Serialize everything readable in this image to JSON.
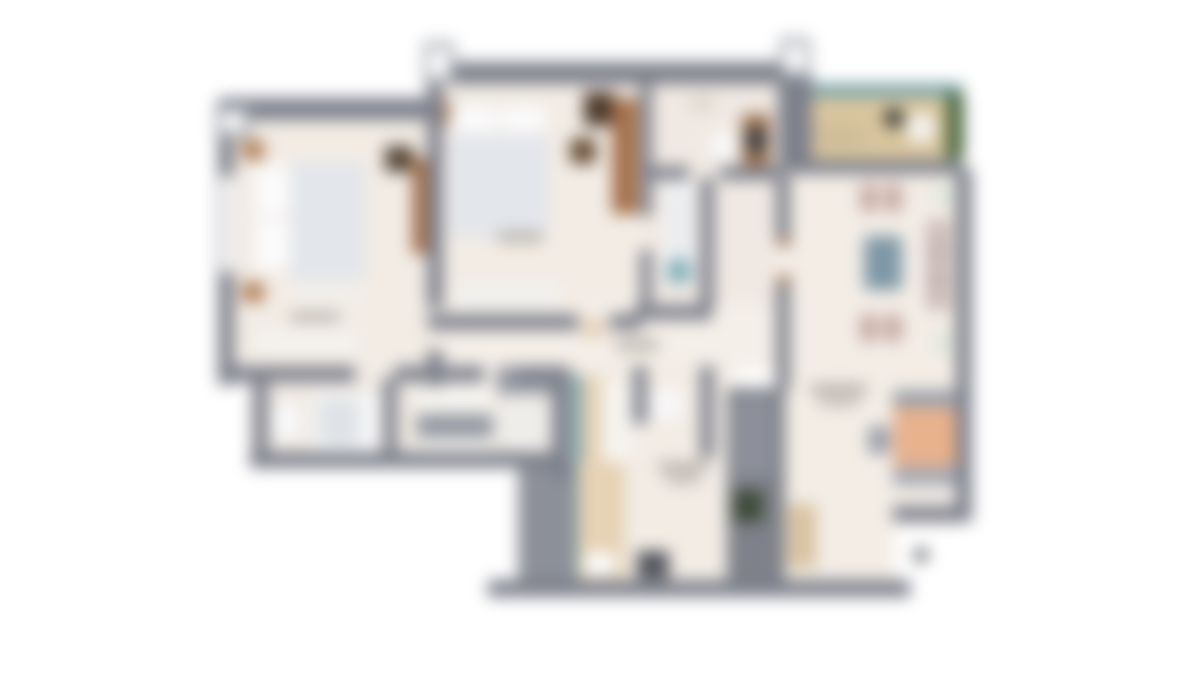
{
  "plan": {
    "background": "#ffffff",
    "blur_px": 8,
    "palette": {
      "wall": "#7d808b",
      "wall_light": "#9aa0a8",
      "floor": "#f2ece5",
      "floor_hall": "#f5efe9",
      "balcony_wood": "#d8c59e",
      "glass_teal": "#5b929b",
      "plant_green": "#4c683f",
      "bed_duvet": "#e3e6eb",
      "pillow_white": "#fbfbfc",
      "wood_brown": "#a5714b",
      "wood_dark": "#57483a",
      "chair_mauve": "#c6a8a2",
      "table_blue": "#7e98a6",
      "sofa_peach": "#e8b28c",
      "kitchen_tan": "#e6d2b4",
      "shaft_gray": "#7e8189",
      "label_smudge": "#b3ada7"
    },
    "shapes": [
      {
        "n": "bedroom1-floor",
        "x": 225,
        "y": 105,
        "w": 210,
        "h": 266,
        "c": "#f2ece5"
      },
      {
        "n": "bedroom2-floor",
        "x": 435,
        "y": 70,
        "w": 210,
        "h": 250,
        "c": "#f2ece5"
      },
      {
        "n": "bathroom-a-floor",
        "x": 645,
        "y": 70,
        "w": 140,
        "h": 104,
        "c": "#f0e9e3"
      },
      {
        "n": "bathroom-b-floor",
        "x": 645,
        "y": 175,
        "w": 135,
        "h": 140,
        "c": "#f0e9e3"
      },
      {
        "n": "balcony-floor",
        "x": 800,
        "y": 92,
        "w": 158,
        "h": 70,
        "c": "#d8c59e"
      },
      {
        "n": "living-floor",
        "x": 783,
        "y": 165,
        "w": 180,
        "h": 360,
        "c": "#f3ede6"
      },
      {
        "n": "living-floor-lower",
        "x": 783,
        "y": 520,
        "w": 112,
        "h": 66,
        "c": "#f3ede6"
      },
      {
        "n": "hall-floor",
        "x": 435,
        "y": 305,
        "w": 355,
        "h": 66,
        "c": "#f5efe9"
      },
      {
        "n": "bathroom-block-floor",
        "x": 248,
        "y": 372,
        "w": 310,
        "h": 88,
        "c": "#efe9e2"
      },
      {
        "n": "entry-floor",
        "x": 565,
        "y": 360,
        "w": 170,
        "h": 224,
        "c": "#f2ece5"
      },
      {
        "n": "bed1-pillow-top",
        "x": 255,
        "y": 166,
        "w": 34,
        "h": 50,
        "c": "#fbfbfc",
        "r": 6
      },
      {
        "n": "bed1-pillow-bottom",
        "x": 255,
        "y": 220,
        "w": 34,
        "h": 50,
        "c": "#fbfbfc",
        "r": 6
      },
      {
        "n": "bed1-duvet",
        "x": 291,
        "y": 162,
        "w": 74,
        "h": 118,
        "c": "#e3e6eb",
        "r": 3
      },
      {
        "n": "bed1-nightstand-top",
        "x": 242,
        "y": 140,
        "w": 22,
        "h": 20,
        "c": "#b08157"
      },
      {
        "n": "bed1-nightstand-bottom",
        "x": 242,
        "y": 282,
        "w": 22,
        "h": 20,
        "c": "#b08157"
      },
      {
        "n": "bed1-dresser",
        "x": 385,
        "y": 146,
        "w": 28,
        "h": 26,
        "c": "#57483a"
      },
      {
        "n": "bed1-bench",
        "x": 293,
        "y": 284,
        "w": 62,
        "h": 20,
        "c": "#f1efec"
      },
      {
        "n": "bed1-low-dresser",
        "x": 258,
        "y": 332,
        "w": 96,
        "h": 22,
        "c": "#f4f2ef"
      },
      {
        "n": "bed1-wardrobe",
        "x": 412,
        "y": 158,
        "w": 16,
        "h": 96,
        "c": "#a5714b"
      },
      {
        "n": "bedroom1-label-smudge",
        "x": 290,
        "y": 312,
        "w": 50,
        "h": 9,
        "c": "#b3ada7",
        "r": 4
      },
      {
        "n": "bed2-pillow-left",
        "x": 453,
        "y": 107,
        "w": 44,
        "h": 25,
        "c": "#fbfbfc",
        "r": 6
      },
      {
        "n": "bed2-pillow-right",
        "x": 501,
        "y": 107,
        "w": 44,
        "h": 25,
        "c": "#fbfbfc",
        "r": 6
      },
      {
        "n": "bed2-duvet",
        "x": 450,
        "y": 134,
        "w": 98,
        "h": 104,
        "c": "#e3e6eb",
        "r": 3
      },
      {
        "n": "bed2-nightstand-left",
        "x": 432,
        "y": 100,
        "w": 18,
        "h": 24,
        "c": "#b08157"
      },
      {
        "n": "bed2-side-chair",
        "x": 570,
        "y": 138,
        "w": 26,
        "h": 26,
        "c": "#6b5138",
        "r": 4
      },
      {
        "n": "bed2-dark-dresser",
        "x": 584,
        "y": 92,
        "w": 30,
        "h": 34,
        "c": "#4e3b2c"
      },
      {
        "n": "bed2-wardrobe",
        "x": 612,
        "y": 98,
        "w": 26,
        "h": 116,
        "c": "#a5714b"
      },
      {
        "n": "bed2-bench",
        "x": 458,
        "y": 284,
        "w": 100,
        "h": 24,
        "c": "#f2f1ee"
      },
      {
        "n": "bedroom2-label-smudge",
        "x": 497,
        "y": 232,
        "w": 46,
        "h": 10,
        "c": "#b3ada7",
        "r": 4
      },
      {
        "n": "bed2-door-swing",
        "x": 580,
        "y": 318,
        "w": 26,
        "h": 20,
        "c": "#e6d2ba",
        "r": 6
      },
      {
        "n": "bathroom-a-vanity",
        "x": 742,
        "y": 114,
        "w": 28,
        "h": 60,
        "c": "#9c7350"
      },
      {
        "n": "bathroom-a-sink",
        "x": 746,
        "y": 128,
        "w": 20,
        "h": 24,
        "c": "#3f4147",
        "r": 4
      },
      {
        "n": "bathroom-a-toilet",
        "x": 710,
        "y": 132,
        "w": 26,
        "h": 28,
        "c": "#f8f8f9",
        "r": 8
      },
      {
        "n": "bathroom-a-shelf",
        "x": 690,
        "y": 96,
        "w": 24,
        "h": 14,
        "c": "#ddd5ca"
      },
      {
        "n": "bathroom-b-tub",
        "x": 664,
        "y": 180,
        "w": 32,
        "h": 100,
        "c": "#f6f6f7",
        "r": 10
      },
      {
        "n": "bathroom-b-tub-inner",
        "x": 670,
        "y": 188,
        "w": 20,
        "h": 84,
        "c": "#e9ebee",
        "r": 8
      },
      {
        "n": "bathroom-b-toilet",
        "x": 666,
        "y": 258,
        "w": 26,
        "h": 26,
        "c": "#7fb0ba",
        "r": "50%"
      },
      {
        "n": "balcony-glass-rail",
        "x": 796,
        "y": 84,
        "w": 166,
        "h": 12,
        "c": "#6f9da3"
      },
      {
        "n": "balcony-plants",
        "x": 946,
        "y": 92,
        "w": 18,
        "h": 68,
        "c": "#4c683f",
        "r": 6
      },
      {
        "n": "balcony-plant-pot",
        "x": 884,
        "y": 108,
        "w": 20,
        "h": 20,
        "c": "#3b3d36",
        "r": "50%"
      },
      {
        "n": "balcony-chair",
        "x": 908,
        "y": 114,
        "w": 26,
        "h": 28,
        "c": "#f5f4f1",
        "r": 6
      },
      {
        "n": "balcony-table",
        "x": 818,
        "y": 128,
        "w": 44,
        "h": 18,
        "c": "#cdbb96",
        "r": 4
      },
      {
        "n": "dining-chair-1",
        "x": 860,
        "y": 184,
        "w": 18,
        "h": 28,
        "c": "#c6a8a2",
        "r": 5
      },
      {
        "n": "dining-chair-2",
        "x": 884,
        "y": 184,
        "w": 18,
        "h": 28,
        "c": "#c6a8a2",
        "r": 5
      },
      {
        "n": "dining-plant-top",
        "x": 932,
        "y": 184,
        "w": 22,
        "h": 22,
        "c": "#dfe8dc",
        "r": "50%"
      },
      {
        "n": "dining-table",
        "x": 864,
        "y": 236,
        "w": 38,
        "h": 54,
        "c": "#7e98a6",
        "r": 4
      },
      {
        "n": "dining-chair-3",
        "x": 860,
        "y": 314,
        "w": 18,
        "h": 28,
        "c": "#c6a8a2",
        "r": 5
      },
      {
        "n": "dining-chair-4",
        "x": 884,
        "y": 314,
        "w": 18,
        "h": 28,
        "c": "#c6a8a2",
        "r": 5
      },
      {
        "n": "dining-plant-bottom",
        "x": 932,
        "y": 332,
        "w": 22,
        "h": 22,
        "c": "#dfe8dc",
        "r": "50%"
      },
      {
        "n": "living-sideboard",
        "x": 926,
        "y": 220,
        "w": 24,
        "h": 90,
        "c": "#ccbbb7",
        "r": 3
      },
      {
        "n": "sideboard-divider-1",
        "x": 926,
        "y": 250,
        "w": 24,
        "h": 4,
        "c": "#a8a4a5"
      },
      {
        "n": "sideboard-divider-2",
        "x": 926,
        "y": 278,
        "w": 24,
        "h": 4,
        "c": "#a8a4a5"
      },
      {
        "n": "living-label-smudge-1",
        "x": 810,
        "y": 384,
        "w": 58,
        "h": 10,
        "c": "#b3ada7",
        "r": 4
      },
      {
        "n": "living-label-smudge-2",
        "x": 818,
        "y": 398,
        "w": 42,
        "h": 8,
        "c": "#b9b4ae",
        "r": 4
      },
      {
        "n": "sofa-back",
        "x": 893,
        "y": 390,
        "w": 64,
        "h": 17,
        "c": "#9aa0aa"
      },
      {
        "n": "sofa-body",
        "x": 893,
        "y": 407,
        "w": 64,
        "h": 59,
        "c": "#e8b28c"
      },
      {
        "n": "sofa-front",
        "x": 893,
        "y": 466,
        "w": 64,
        "h": 20,
        "c": "#a7abb4"
      },
      {
        "n": "sofa-ottoman",
        "x": 868,
        "y": 426,
        "w": 22,
        "h": 28,
        "c": "#9aa0aa",
        "r": 4
      },
      {
        "n": "tv-console",
        "x": 788,
        "y": 504,
        "w": 28,
        "h": 64,
        "c": "#d8c39f"
      },
      {
        "n": "hall-label-smudge",
        "x": 615,
        "y": 340,
        "w": 44,
        "h": 10,
        "c": "#b3ada7",
        "r": 4
      },
      {
        "n": "hall-wardrobe-top",
        "x": 417,
        "y": 384,
        "w": 76,
        "h": 27,
        "c": "#f6f4f0"
      },
      {
        "n": "hall-wardrobe-mid",
        "x": 417,
        "y": 414,
        "w": 76,
        "h": 24,
        "c": "#9599a3"
      },
      {
        "n": "hall-wardrobe-bottom",
        "x": 417,
        "y": 441,
        "w": 76,
        "h": 22,
        "c": "#f6f4f0"
      },
      {
        "n": "shower-cap",
        "x": 497,
        "y": 366,
        "w": 58,
        "h": 28,
        "c": "#9699a3"
      },
      {
        "n": "shower-disc",
        "x": 495,
        "y": 394,
        "w": 56,
        "h": 58,
        "c": "#efedea",
        "r": "50%"
      },
      {
        "n": "bathroom-1-toilet",
        "x": 274,
        "y": 402,
        "w": 26,
        "h": 38,
        "c": "#f8f8f9",
        "r": 8
      },
      {
        "n": "bathroom-1-vanity",
        "x": 312,
        "y": 392,
        "w": 68,
        "h": 60,
        "c": "#f7f7f8",
        "r": 4
      },
      {
        "n": "bathroom-1-vanity-inner",
        "x": 318,
        "y": 398,
        "w": 42,
        "h": 48,
        "c": "#dfe3e7",
        "r": 4
      },
      {
        "n": "kitchen-glass-upper",
        "x": 573,
        "y": 375,
        "w": 8,
        "h": 100,
        "c": "#5b929b"
      },
      {
        "n": "kitchen-counter-upper",
        "x": 582,
        "y": 377,
        "w": 20,
        "h": 88,
        "c": "#e6d2b4"
      },
      {
        "n": "kitchen-counter-white",
        "x": 603,
        "y": 382,
        "w": 28,
        "h": 84,
        "c": "#f6f4f0"
      },
      {
        "n": "stair-block",
        "x": 518,
        "y": 462,
        "w": 56,
        "h": 120,
        "c": "#8d9099"
      },
      {
        "n": "kitchen-glass-lower",
        "x": 573,
        "y": 462,
        "w": 8,
        "h": 120,
        "c": "#5b929b"
      },
      {
        "n": "kitchen-counter-lower",
        "x": 577,
        "y": 462,
        "w": 48,
        "h": 120,
        "c": "#e6d2b4"
      },
      {
        "n": "kitchen-sink",
        "x": 585,
        "y": 552,
        "w": 30,
        "h": 24,
        "c": "#fafafa",
        "r": 4
      },
      {
        "n": "wc-fixture",
        "x": 650,
        "y": 390,
        "w": 32,
        "h": 30,
        "c": "#f8f8f9",
        "r": 8
      },
      {
        "n": "entry-label-smudge-1",
        "x": 658,
        "y": 462,
        "w": 50,
        "h": 10,
        "c": "#b3ada7",
        "r": 4
      },
      {
        "n": "entry-label-smudge-2",
        "x": 666,
        "y": 476,
        "w": 34,
        "h": 8,
        "c": "#b9b4ae",
        "r": 4
      },
      {
        "n": "entry-door",
        "x": 637,
        "y": 551,
        "w": 32,
        "h": 28,
        "c": "#54565e"
      },
      {
        "n": "utility-shaft",
        "x": 727,
        "y": 388,
        "w": 58,
        "h": 194,
        "c": "#7e8189"
      },
      {
        "n": "utility-shaft-inner",
        "x": 733,
        "y": 396,
        "w": 40,
        "h": 80,
        "c": "#8d909a"
      },
      {
        "n": "fridge",
        "x": 733,
        "y": 490,
        "w": 30,
        "h": 32,
        "c": "#3e4b3a"
      },
      {
        "n": "outside-marker-dot",
        "x": 914,
        "y": 548,
        "w": 14,
        "h": 14,
        "c": "#6e7076",
        "r": 4
      },
      {
        "n": "wall-bedroom2-top",
        "x": 443,
        "y": 62,
        "w": 350,
        "h": 22,
        "c": "#7d808b"
      },
      {
        "n": "wall-bedroom1-top",
        "x": 218,
        "y": 98,
        "w": 225,
        "h": 22,
        "c": "#7d808b"
      },
      {
        "n": "wall-left",
        "x": 218,
        "y": 98,
        "w": 16,
        "h": 287,
        "c": "#7d808b"
      },
      {
        "n": "wall-bedroom1-east-upper",
        "x": 427,
        "y": 62,
        "w": 16,
        "h": 246,
        "c": "#7d808b"
      },
      {
        "n": "wall-bedroom1-east-lower",
        "x": 427,
        "y": 350,
        "w": 16,
        "h": 36,
        "c": "#7d808b"
      },
      {
        "n": "wall-bedroom1-south-1",
        "x": 218,
        "y": 366,
        "w": 137,
        "h": 16,
        "c": "#7d808b"
      },
      {
        "n": "wall-bedroom1-south-2",
        "x": 395,
        "y": 366,
        "w": 89,
        "h": 16,
        "c": "#7d808b"
      },
      {
        "n": "wall-bedroom1-south-3",
        "x": 516,
        "y": 366,
        "w": 54,
        "h": 16,
        "c": "#7d808b"
      },
      {
        "n": "wall-bedroom2-east-upper",
        "x": 640,
        "y": 84,
        "w": 12,
        "h": 132,
        "c": "#7d808b"
      },
      {
        "n": "wall-bedroom2-east-lower",
        "x": 640,
        "y": 250,
        "w": 12,
        "h": 66,
        "c": "#7d808b"
      },
      {
        "n": "wall-bedroom2-south-1",
        "x": 428,
        "y": 314,
        "w": 150,
        "h": 16,
        "c": "#7d808b"
      },
      {
        "n": "wall-bedroom2-south-2",
        "x": 610,
        "y": 314,
        "w": 32,
        "h": 16,
        "c": "#7d808b"
      },
      {
        "n": "wall-bathroom-divider-1",
        "x": 643,
        "y": 166,
        "w": 46,
        "h": 14,
        "c": "#7d808b"
      },
      {
        "n": "wall-bathroom-divider-2",
        "x": 720,
        "y": 166,
        "w": 60,
        "h": 14,
        "c": "#7d808b"
      },
      {
        "n": "wall-bathroom-b-east",
        "x": 700,
        "y": 178,
        "w": 14,
        "h": 130,
        "c": "#7d808b"
      },
      {
        "n": "wall-bathroom-b-south",
        "x": 635,
        "y": 305,
        "w": 77,
        "h": 15,
        "c": "#7d808b"
      },
      {
        "n": "wall-shaft-top",
        "x": 778,
        "y": 74,
        "w": 34,
        "h": 96,
        "c": "#7d808b"
      },
      {
        "n": "wall-under-balcony",
        "x": 788,
        "y": 160,
        "w": 174,
        "h": 14,
        "c": "#7d808b"
      },
      {
        "n": "wall-living-west-upper",
        "x": 776,
        "y": 174,
        "w": 14,
        "h": 64,
        "c": "#7d808b"
      },
      {
        "n": "wall-living-west-lower",
        "x": 776,
        "y": 284,
        "w": 14,
        "h": 106,
        "c": "#7d808b"
      },
      {
        "n": "living-door-jamb-top",
        "x": 778,
        "y": 238,
        "w": 12,
        "h": 9,
        "c": "#a5714b"
      },
      {
        "n": "living-door-jamb-bottom",
        "x": 778,
        "y": 275,
        "w": 12,
        "h": 9,
        "c": "#a5714b"
      },
      {
        "n": "wall-living-east",
        "x": 956,
        "y": 168,
        "w": 16,
        "h": 354,
        "c": "#7d808b"
      },
      {
        "n": "wall-living-step",
        "x": 893,
        "y": 506,
        "w": 78,
        "h": 16,
        "c": "#7d808b"
      },
      {
        "n": "wall-bottom",
        "x": 488,
        "y": 580,
        "w": 422,
        "h": 17,
        "c": "#7d808b"
      },
      {
        "n": "wall-bathblock-west",
        "x": 253,
        "y": 380,
        "w": 15,
        "h": 82,
        "c": "#7d808b"
      },
      {
        "n": "wall-bathblock-divider",
        "x": 383,
        "y": 378,
        "w": 14,
        "h": 84,
        "c": "#7d808b"
      },
      {
        "n": "wall-bathblock-south",
        "x": 250,
        "y": 452,
        "w": 312,
        "h": 16,
        "c": "#7d808b"
      },
      {
        "n": "wall-bathblock-east",
        "x": 552,
        "y": 366,
        "w": 18,
        "h": 112,
        "c": "#7d808b"
      },
      {
        "n": "wall-wc-west",
        "x": 633,
        "y": 366,
        "w": 14,
        "h": 58,
        "c": "#7d808b"
      },
      {
        "n": "wall-wc-east",
        "x": 700,
        "y": 366,
        "w": 14,
        "h": 92,
        "c": "#7d808b"
      },
      {
        "n": "bed1-window",
        "x": 221,
        "y": 176,
        "w": 12,
        "h": 96,
        "c": "#ffffff"
      },
      {
        "n": "column-stub-bedroom2-outer",
        "x": 424,
        "y": 42,
        "w": 30,
        "h": 42,
        "c": "#9aa0a8"
      },
      {
        "n": "column-stub-bedroom2-inner",
        "x": 429,
        "y": 48,
        "w": 20,
        "h": 30,
        "c": "#ffffff"
      },
      {
        "n": "column-stub-shaft-outer",
        "x": 780,
        "y": 38,
        "w": 30,
        "h": 40,
        "c": "#9aa0a8"
      },
      {
        "n": "column-stub-shaft-inner",
        "x": 785,
        "y": 44,
        "w": 20,
        "h": 28,
        "c": "#ffffff"
      },
      {
        "n": "column-stub-bedroom1-outer",
        "x": 216,
        "y": 106,
        "w": 34,
        "h": 32,
        "c": "#9aa0a8"
      },
      {
        "n": "column-stub-bedroom1-inner",
        "x": 222,
        "y": 112,
        "w": 22,
        "h": 20,
        "c": "#ffffff"
      }
    ]
  }
}
